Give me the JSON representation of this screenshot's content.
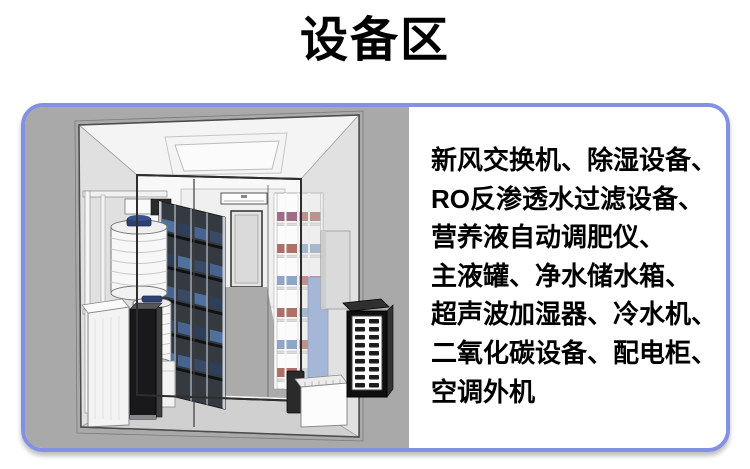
{
  "title": "设备区",
  "panel": {
    "border_color": "#8490e4",
    "illustration": {
      "label": "equipment-room-3d-rendering",
      "background_color": "#a9a9a9"
    },
    "equipment_list": {
      "lines": [
        "新风交换机、除湿设备、",
        "RO反渗透水过滤设备、",
        "营养液自动调肥仪、",
        "主液罐、净水储水箱、",
        "超声波加湿器、冷水机、",
        "二氧化碳设备、配电柜、",
        "空调外机"
      ]
    }
  }
}
